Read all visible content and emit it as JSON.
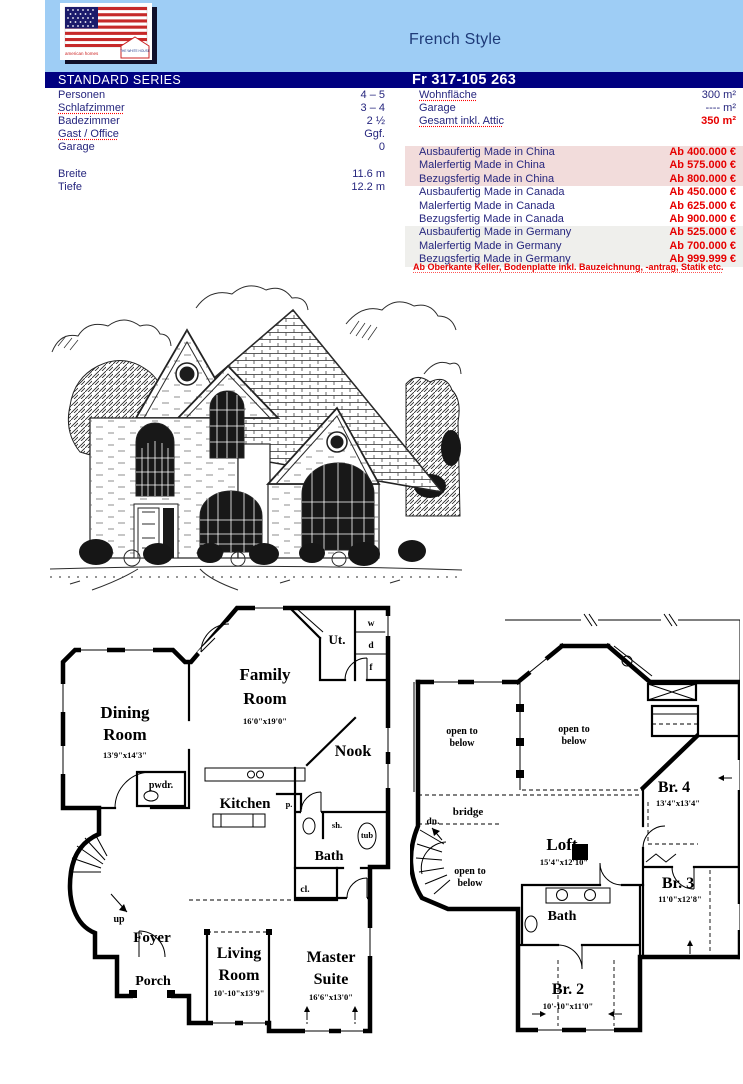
{
  "colors": {
    "band_blue": "#9ecdf5",
    "bar_navy": "#000080",
    "text_navy": "#26267e",
    "price_red": "#e60000",
    "row_pink": "#f2dcdb",
    "row_gray": "#efefec"
  },
  "header": {
    "title": "French Style",
    "logo": {
      "brand": "american homes",
      "badge": "THE WHITE HOUSE"
    }
  },
  "bar": {
    "series": "STANDARD SERIES",
    "model": "Fr 317-105 263"
  },
  "specs": [
    {
      "label": "Personen",
      "value": "4 – 5"
    },
    {
      "label": "Schlafzimmer",
      "value": "3 – 4"
    },
    {
      "label": "Badezimmer",
      "value": "2 ½"
    },
    {
      "label": "Gast / Office",
      "value": "Ggf."
    },
    {
      "label": "Garage",
      "value": "0"
    },
    {
      "label": "",
      "value": ""
    },
    {
      "label": "Breite",
      "value": "11.6 m"
    },
    {
      "label": "Tiefe",
      "value": "12.2 m"
    }
  ],
  "areas": [
    {
      "label": "Wohnfläche",
      "value": "300 m²"
    },
    {
      "label": "Garage",
      "value": "---- m²"
    },
    {
      "label": "Gesamt inkl. Attic",
      "value": "350 m²"
    }
  ],
  "prices": [
    {
      "label": "Ausbaufertig Made in China",
      "value": "Ab 400.000 €"
    },
    {
      "label": "Malerfertig Made in China",
      "value": "Ab 575.000 €"
    },
    {
      "label": "Bezugsfertig Made in China",
      "value": "Ab 800.000 €"
    },
    {
      "label": "Ausbaufertig Made in Canada",
      "value": "Ab 450.000 €"
    },
    {
      "label": "Malerfertig Made in Canada",
      "value": "Ab 625.000 €"
    },
    {
      "label": "Bezugsfertig Made in Canada",
      "value": "Ab 900.000 €"
    },
    {
      "label": "Ausbaufertig Made in Germany",
      "value": "Ab 525.000 €"
    },
    {
      "label": "Malerfertig Made in Germany",
      "value": "Ab 700.000 €"
    },
    {
      "label": "Bezugsfertig Made in Germany",
      "value": "Ab 999.999 €"
    }
  ],
  "footnote": "Ab Oberkante Keller, Bodenplatte inkl. Bauzeichnung, -antrag, Statik etc.",
  "plan1": {
    "dining": [
      "Dining",
      "Room"
    ],
    "dining_dims": "13'9\"x14'3\"",
    "family": [
      "Family",
      "Room"
    ],
    "family_dims": "16'0\"x19'0\"",
    "ut": "Ut.",
    "w": "w",
    "d": "d",
    "f": "f",
    "nook": "Nook",
    "pwdr": "pwdr.",
    "kitchen": "Kitchen",
    "p": "p.",
    "sh": "sh.",
    "tub": "tub",
    "bath": "Bath",
    "cl": "cl.",
    "up": "up",
    "foyer": "Foyer",
    "living": [
      "Living",
      "Room"
    ],
    "living_dims": "10'-10\"x13'9\"",
    "porch": "Porch",
    "master": [
      "Master",
      "Suite"
    ],
    "master_dims": "16'6\"x13'0\""
  },
  "plan2": {
    "otb": [
      "open to",
      "below"
    ],
    "bridge": "bridge",
    "dn": "dn.",
    "loft": "Loft",
    "loft_dims": "15'4\"x12'10\"",
    "br4": "Br. 4",
    "br4_dims": "13'4\"x13'4\"",
    "br3": "Br. 3",
    "br3_dims": "11'0\"x12'8\"",
    "br2": "Br. 2",
    "br2_dims": "10'-10\"x11'0\"",
    "bath": "Bath"
  }
}
